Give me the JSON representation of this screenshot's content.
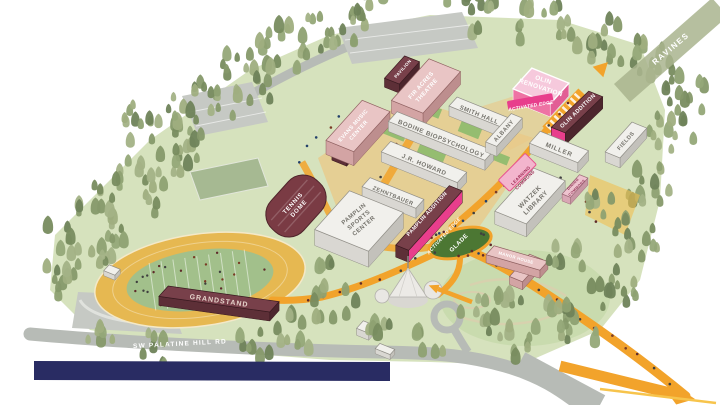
{
  "map": {
    "regions": {
      "ravines": "RAVINES",
      "glade": "GLADE"
    },
    "roads": {
      "palatine": "SW PALATINE HILL RD"
    },
    "buildings": [
      {
        "id": "pavilion",
        "lines": [
          "PAVILION"
        ],
        "style": "maroon"
      },
      {
        "id": "fir-acres-theatre",
        "lines": [
          "FIR ACRES",
          "THEATRE"
        ],
        "style": "pink"
      },
      {
        "id": "evans-music-center",
        "lines": [
          "EVANS MUSIC",
          "CENTER"
        ],
        "style": "pink"
      },
      {
        "id": "bodine-biopsychology",
        "lines": [
          "BODINE BIOPSYCHOLOGY"
        ],
        "style": "white"
      },
      {
        "id": "smith-hall",
        "lines": [
          "SMITH HALL"
        ],
        "style": "white"
      },
      {
        "id": "albany",
        "lines": [
          "ALBANY"
        ],
        "style": "white"
      },
      {
        "id": "olin-renovation",
        "lines": [
          "OLIN",
          "RENOVATION"
        ],
        "style": "highlight-pink"
      },
      {
        "id": "olin-addition",
        "lines": [
          "OLIN ADDITION"
        ],
        "style": "maroon"
      },
      {
        "id": "miller",
        "lines": [
          "MILLER"
        ],
        "style": "white"
      },
      {
        "id": "fields",
        "lines": [
          "FIELDS"
        ],
        "style": "white"
      },
      {
        "id": "jr-howard",
        "lines": [
          "J.R. HOWARD"
        ],
        "style": "white"
      },
      {
        "id": "zehntbauer",
        "lines": [
          "ZEHNTBAUER"
        ],
        "style": "white"
      },
      {
        "id": "pamplin-sports-center",
        "lines": [
          "PAMPLIN",
          "SPORTS",
          "CENTER"
        ],
        "style": "white"
      },
      {
        "id": "pamplin-addition",
        "lines": [
          "PAMPLIN ADDITION"
        ],
        "style": "maroon"
      },
      {
        "id": "tennis-dome",
        "lines": [
          "TENNIS",
          "DOME"
        ],
        "style": "maroon"
      },
      {
        "id": "watzek-library",
        "lines": [
          "WATZEK",
          "LIBRARY"
        ],
        "style": "white"
      },
      {
        "id": "dining-commons",
        "lines": [
          "DINING",
          "COMMONS"
        ],
        "style": "pink"
      },
      {
        "id": "manor-house",
        "lines": [
          "MANOR HOUSE"
        ],
        "style": "pink"
      },
      {
        "id": "grandstand",
        "lines": [
          "GRANDSTAND"
        ],
        "style": "maroon"
      }
    ],
    "highlights": [
      {
        "id": "activated-edge-north",
        "lines": [
          "ACTIVATED EDGE"
        ]
      },
      {
        "id": "activated-edge-south",
        "lines": [
          "ACTIVATED EDGE"
        ]
      },
      {
        "id": "learning-commons",
        "lines": [
          "LEARNING",
          "COMMONS"
        ]
      }
    ],
    "colors": {
      "path_orange": "#F2A32B",
      "highlight_pink": "#E83E8C",
      "building_maroon": "#78404A",
      "building_pink": "#E9C5C5",
      "building_white": "#F1F0EC",
      "glade_green": "#4C7733",
      "lawn_green": "#D6E2BD",
      "forest_green": "#8EA172",
      "road_gray": "#B7BBB6",
      "band_navy": "#292C63",
      "track_gold": "#E6B851",
      "field_green": "#A2C08B"
    }
  }
}
